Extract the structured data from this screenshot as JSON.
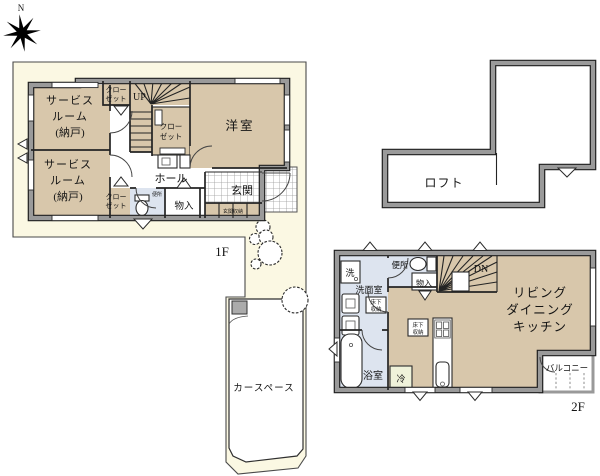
{
  "page": {
    "compass_north": "N"
  },
  "colors": {
    "site": "#FBF8E3",
    "room": "#D8C7AB",
    "wet": "#DDE4EF",
    "wall": "#9A9A9A",
    "fridge": "#EFF2DA",
    "graybox": "#ABABAB"
  },
  "floor1": {
    "label": "1F",
    "rooms": {
      "service1": {
        "l1": "サービス",
        "l2": "ルーム",
        "l3": "(納戸)"
      },
      "service2": {
        "l1": "サービス",
        "l2": "ルーム",
        "l3": "(納戸)"
      },
      "closet_top": {
        "l1": "クロー",
        "l2": "ゼット"
      },
      "closet_mid": {
        "l1": "クロー",
        "l2": "ゼット"
      },
      "closet_bottom": {
        "l1": "クロー",
        "l2": "ゼット"
      },
      "stairs": "UP",
      "western": "洋室",
      "hall": "ホール",
      "entrance": "玄関",
      "storage": "物入",
      "toilet": "便所",
      "entrance_storage": "玄関収納"
    }
  },
  "loft": {
    "label": "ロフト"
  },
  "floor2": {
    "label": "2F",
    "rooms": {
      "washer": "洗",
      "washroom": "洗面室",
      "toilet": "便所",
      "storage": "物入",
      "stairs": "DN",
      "ldk": {
        "l1": "リビング",
        "l2": "ダイニング",
        "l3": "キッチン"
      },
      "underfloor1": {
        "l1": "床下",
        "l2": "収納"
      },
      "underfloor2": {
        "l1": "床下",
        "l2": "収納"
      },
      "bath": "浴室",
      "fridge": "冷",
      "balcony": "バルコニー"
    }
  },
  "site": {
    "car_space": "カースペース"
  }
}
